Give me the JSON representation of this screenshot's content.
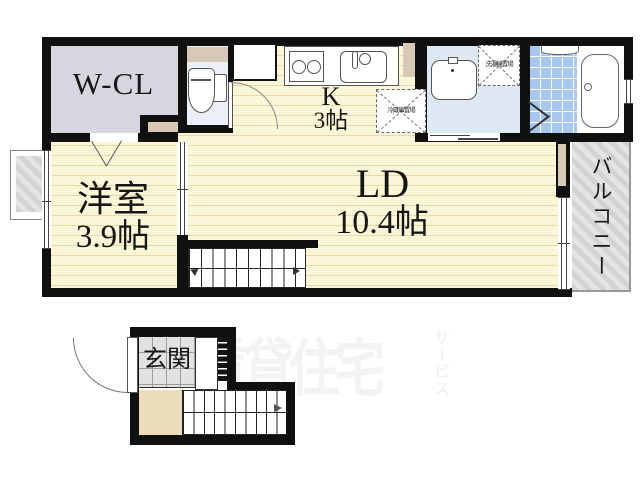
{
  "plan": {
    "rooms": {
      "wcl": {
        "label": "W-CL"
      },
      "western": {
        "name": "洋室",
        "size": "3.9帖"
      },
      "kitchen": {
        "name": "K",
        "size": "3帖"
      },
      "ld": {
        "name": "LD",
        "size": "10.4帖"
      },
      "balcony": {
        "name": "バルコニー"
      },
      "entrance": {
        "name": "玄関"
      }
    },
    "fixtures": {
      "fridge_space": "冷蔵庫置場",
      "washer_space": "洗濯機置場"
    },
    "watermark": {
      "main": "賃貸住宅",
      "sub": "サービス"
    },
    "colors": {
      "wall": "#101010",
      "floor_yellow": "#fcf6d8",
      "floor_stripe": "#ead9a6",
      "wcl_floor": "#d9d5de",
      "toilet_floor": "#eaeffa",
      "washroom_floor": "#dfe9f4",
      "bath_tile": "#a7c8ee",
      "accent_beige": "#d8c8b6",
      "balcony_hatch": "#d3d3d3",
      "entrance_tile": "#e2e2e2",
      "landing_beige": "#eddcba",
      "watermark": "#f3f3f3"
    }
  }
}
